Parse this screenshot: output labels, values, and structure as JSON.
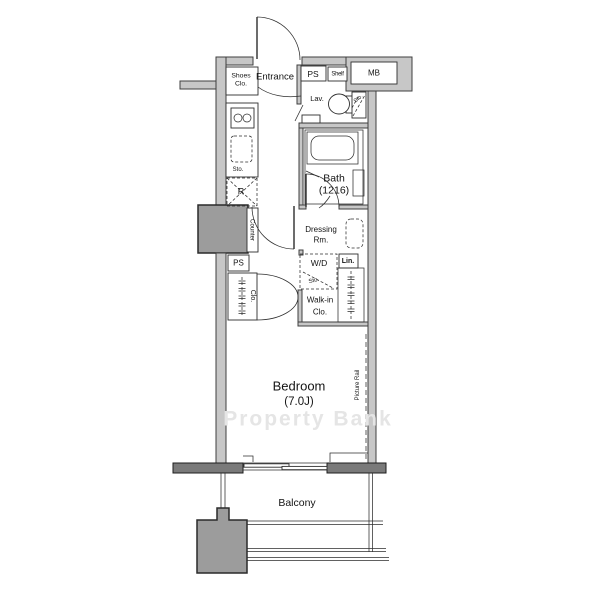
{
  "plan": {
    "labels": {
      "entrance": "Entrance",
      "shoes_1": "Shoes",
      "shoes_2": "Clo.",
      "ps_top": "PS",
      "shelf": "Shelf",
      "mb": "MB",
      "lav": "Lav.",
      "sto_lav": "Sto.",
      "sto_kitchen": "Sto.",
      "refrigerator": "R",
      "counter": "Counter",
      "bath_1": "Bath",
      "bath_2": "(1216)",
      "dressing_1": "Dressing",
      "dressing_2": "Rm.",
      "wd": "W/D",
      "sto_wd": "Sto.",
      "lin": "Lin.",
      "walkin_1": "Walk-in",
      "walkin_2": "Clo.",
      "ps_shaft": "PS",
      "closet": "Clo.",
      "bedroom_1": "Bedroom",
      "bedroom_2": "(7.0J)",
      "picture_rail": "Picture Rail",
      "balcony": "Balcony",
      "watermark": "Property Bank"
    },
    "colors": {
      "wall_fill": "#c7c7c7",
      "wall_dark_fill": "#7a7a7a",
      "pillar_fill": "#9c9c9c",
      "line": "#2e2e2e",
      "watermark": "#e5e5e5",
      "background": "#ffffff"
    }
  }
}
